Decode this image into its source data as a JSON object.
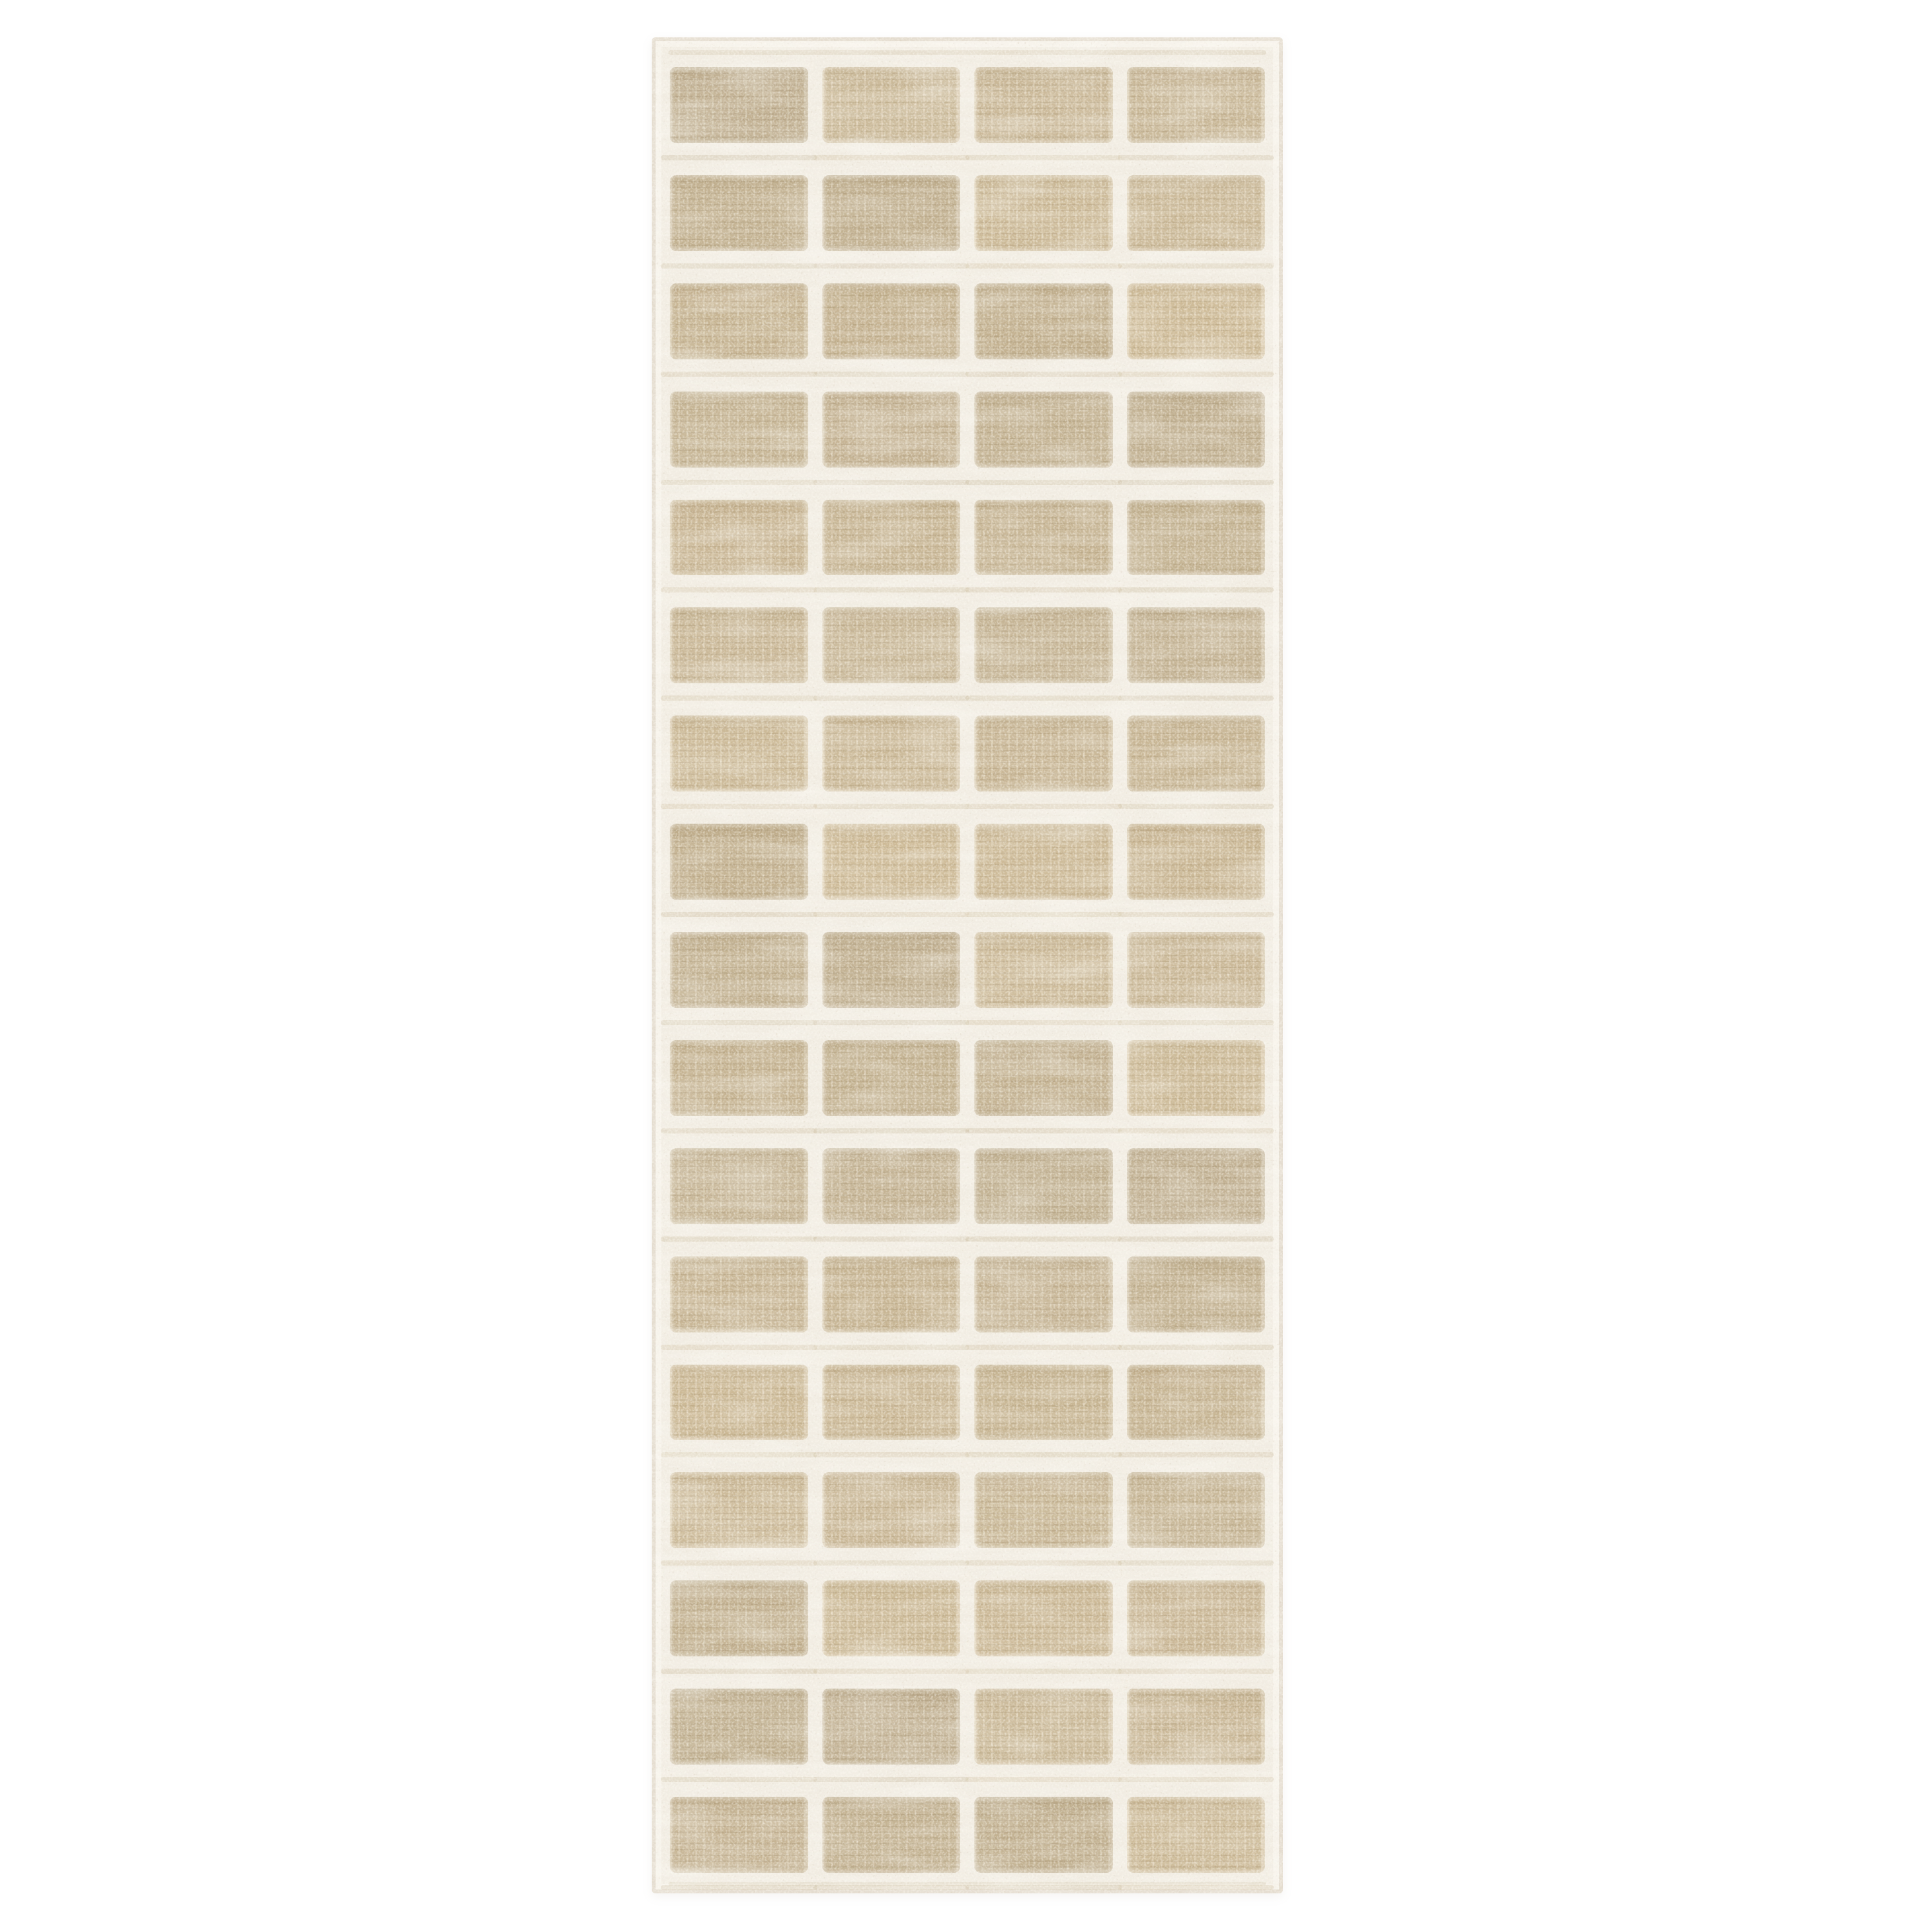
{
  "scene": {
    "description": "Product photo of a cream and beige checkerboard-grid runner rug, photographed flat on a plain white background",
    "subject": "runner rug",
    "orientation": "vertical runner, centered horizontally"
  },
  "rug": {
    "columns": 4,
    "rows": 17,
    "pattern": "grid of rounded beige textured pile rectangles separated by raised cream lines",
    "texture": "high-low boucle pile with cream speckle and fine horizontal weft lines",
    "border": "cream band around all four sides with a thin darker binding at the outer edge"
  },
  "colors": {
    "background": "#ffffff",
    "rug_base": "#f1ece2",
    "cell_beige": "#c8b695",
    "cell_highlight": "#e7ddc6",
    "cell_shadow": "#a6916c",
    "edge_line": "#d6cbb8",
    "gap_stripe": "#c6b696"
  }
}
